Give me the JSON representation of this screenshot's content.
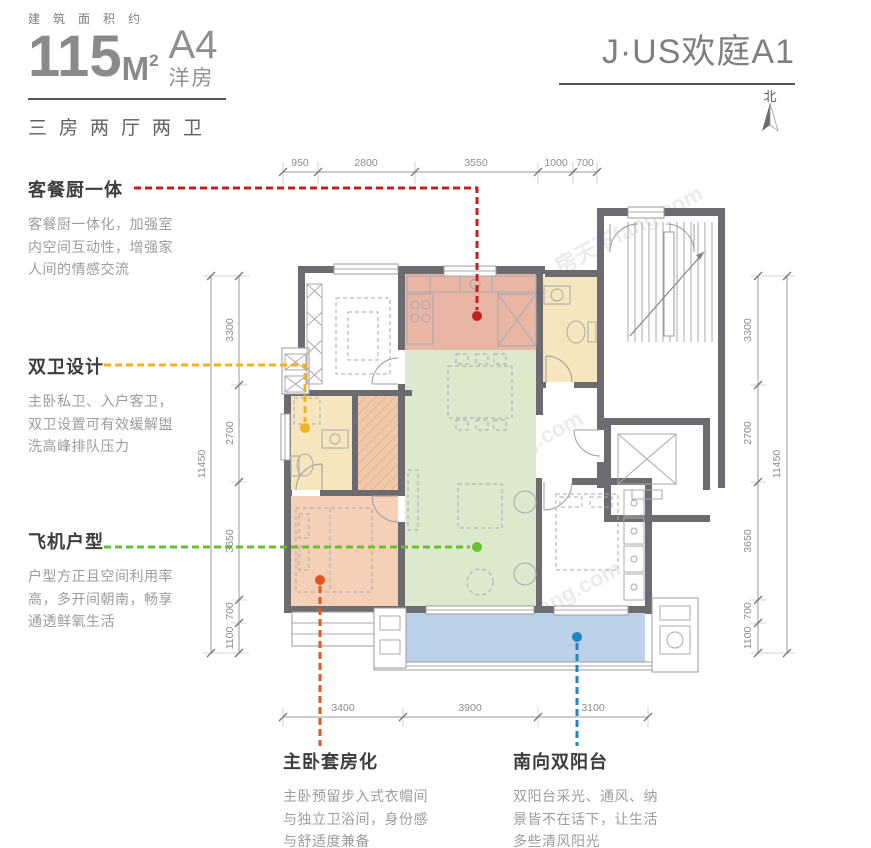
{
  "header": {
    "area_label": "建筑面积约",
    "area_number": "115",
    "area_unit_letter": "M",
    "area_unit_sup": "2",
    "type_code": "A4",
    "type_name": "洋房",
    "layout_summary": "三房两厅两卫",
    "project_name": "J·US欢庭A1",
    "north_label": "北"
  },
  "callouts": [
    {
      "title": "客餐厨一体",
      "desc": "客餐厨一体化，加强室内空间互动性，增强家人间的情感交流",
      "color": "#c2211f"
    },
    {
      "title": "双卫设计",
      "desc": "主卧私卫、入户客卫，双卫设置可有效缓解盥洗高峰排队压力",
      "color": "#f4b223"
    },
    {
      "title": "飞机户型",
      "desc": "户型方正且空间利用率高，多开间朝南，畅享通透鲜氧生活",
      "color": "#64c22d"
    },
    {
      "title": "主卧套房化",
      "desc": "主卧预留步入式衣帽间与独立卫浴间，身份感与舒适度兼备",
      "color": "#e4561c"
    },
    {
      "title": "南向双阳台",
      "desc": "双阳台采光、通风、纳景皆不在话下，让生活多些清风阳光",
      "color": "#1e86c8"
    }
  ],
  "dimensions": {
    "top": [
      "950",
      "2800",
      "3550",
      "1000",
      "700"
    ],
    "bottom": [
      "3400",
      "3900",
      "3100"
    ],
    "side": [
      "3300",
      "2700",
      "3650",
      "700",
      "1100"
    ],
    "side_total": "11450"
  },
  "watermark": "房天下fang.com",
  "colors": {
    "kitchen": "#e9b5a4",
    "living": "#dce9cc",
    "bath": "#f6e6bd",
    "bedroom": "#f6d0b6",
    "closet": "#f2c9a8",
    "balcony": "#bdd2e8"
  }
}
